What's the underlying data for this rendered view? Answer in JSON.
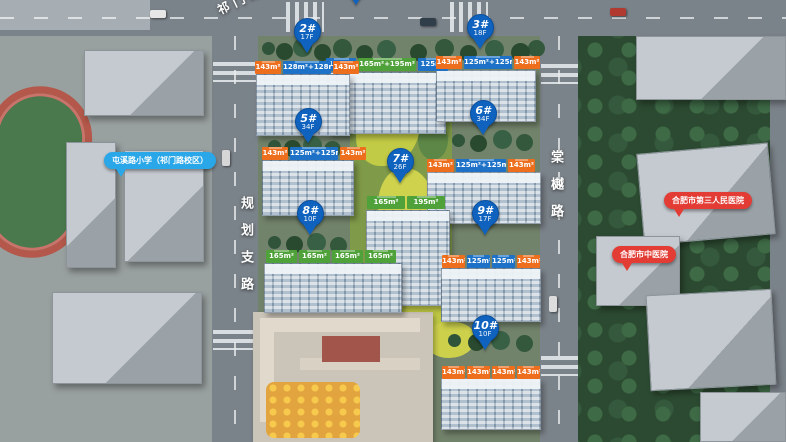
{
  "palette": {
    "pin_blue": "#0f63bf",
    "label_blue": "#1d72c8",
    "label_orange": "#ed6f1e",
    "label_green": "#4fa23a",
    "poi_red": "#e23c34",
    "poi_blue": "#2aa7e8"
  },
  "roads": {
    "top": "祁门路",
    "left": "规划支路",
    "right": "棠樾路"
  },
  "pois": {
    "school": {
      "label": "屯溪路小学（祁门路校区）"
    },
    "hospital_1": {
      "label": "合肥市第三人民医院"
    },
    "hospital_2": {
      "label": "合肥市中医院"
    }
  },
  "buildings": [
    {
      "id": "",
      "floors": "",
      "units": [
        {
          "text": "125m²",
          "color": "blue"
        },
        {
          "text": "165m²+195m²",
          "color": "green"
        },
        {
          "text": "125m²",
          "color": "blue"
        }
      ]
    },
    {
      "id": "2#",
      "floors": "17F",
      "units": [
        {
          "text": "143m²",
          "color": "orange"
        },
        {
          "text": "128m²+128m²",
          "color": "blue"
        },
        {
          "text": "143m²",
          "color": "orange"
        }
      ]
    },
    {
      "id": "3#",
      "floors": "18F",
      "units": [
        {
          "text": "143m²",
          "color": "orange"
        },
        {
          "text": "125m²+125m²",
          "color": "blue"
        },
        {
          "text": "143m²",
          "color": "orange"
        }
      ]
    },
    {
      "id": "5#",
      "floors": "34F",
      "units": [
        {
          "text": "143m²",
          "color": "orange"
        },
        {
          "text": "125m²+125m²",
          "color": "blue"
        },
        {
          "text": "143m²",
          "color": "orange"
        }
      ]
    },
    {
      "id": "6#",
      "floors": "34F",
      "units": [
        {
          "text": "143m²",
          "color": "orange"
        },
        {
          "text": "125m²+125m²",
          "color": "blue"
        },
        {
          "text": "143m²",
          "color": "orange"
        }
      ]
    },
    {
      "id": "7#",
      "floors": "26F",
      "units": [
        {
          "text": "165m²",
          "color": "green"
        },
        {
          "text": "195m²",
          "color": "green"
        }
      ]
    },
    {
      "id": "8#",
      "floors": "10F",
      "units": [
        {
          "text": "165m²",
          "color": "green"
        },
        {
          "text": "165m²",
          "color": "green"
        },
        {
          "text": "165m²",
          "color": "green"
        },
        {
          "text": "165m²",
          "color": "green"
        }
      ]
    },
    {
      "id": "9#",
      "floors": "17F",
      "units": [
        {
          "text": "143m²",
          "color": "orange"
        },
        {
          "text": "125m²",
          "color": "blue"
        },
        {
          "text": "125m²",
          "color": "blue"
        },
        {
          "text": "143m²",
          "color": "orange"
        }
      ]
    },
    {
      "id": "10#",
      "floors": "10F",
      "units": [
        {
          "text": "143m²",
          "color": "orange"
        },
        {
          "text": "143m²",
          "color": "orange"
        },
        {
          "text": "143m²",
          "color": "orange"
        },
        {
          "text": "143m²",
          "color": "orange"
        }
      ]
    }
  ]
}
